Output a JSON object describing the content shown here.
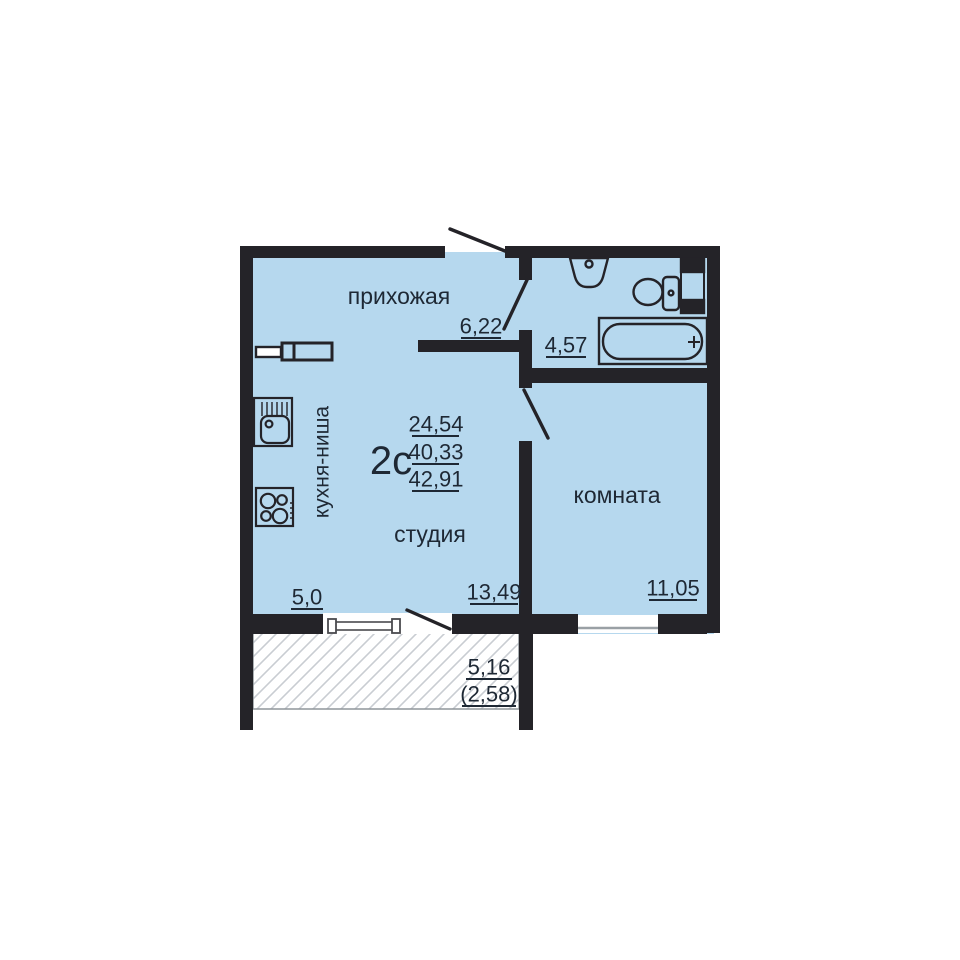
{
  "floor_plan": {
    "apartment_type": "2с",
    "area_living": "24,54",
    "area_total": "40,33",
    "area_total_with_balcony": "42,91",
    "rooms": {
      "hallway": {
        "label": "прихожая",
        "area": "6,22"
      },
      "bathroom": {
        "area": "4,57"
      },
      "kitchen_niche": {
        "label": "кухня-ниша",
        "area": "5,0"
      },
      "studio": {
        "label": "студия",
        "area": "13,49"
      },
      "room": {
        "label": "комната",
        "area": "11,05"
      },
      "balcony": {
        "area": "5,16",
        "area_coefficient": "(2,58)"
      }
    },
    "icons": {
      "bathroom": [
        "washbasin-icon",
        "toilet-icon",
        "towel-dryer-icon",
        "bathtub-icon"
      ],
      "kitchen": [
        "wardrobe-icon",
        "kitchen-sink-icon",
        "stove-icon"
      ],
      "openings": [
        "entry-door-icon",
        "bathroom-door-icon",
        "room-door-icon",
        "balcony-door-icon",
        "window-icon"
      ]
    },
    "colors": {
      "room_fill": "#b6d8ee",
      "wall": "#242328",
      "text": "#1e2834",
      "balcony_hatch": "#c9cdd2"
    }
  }
}
